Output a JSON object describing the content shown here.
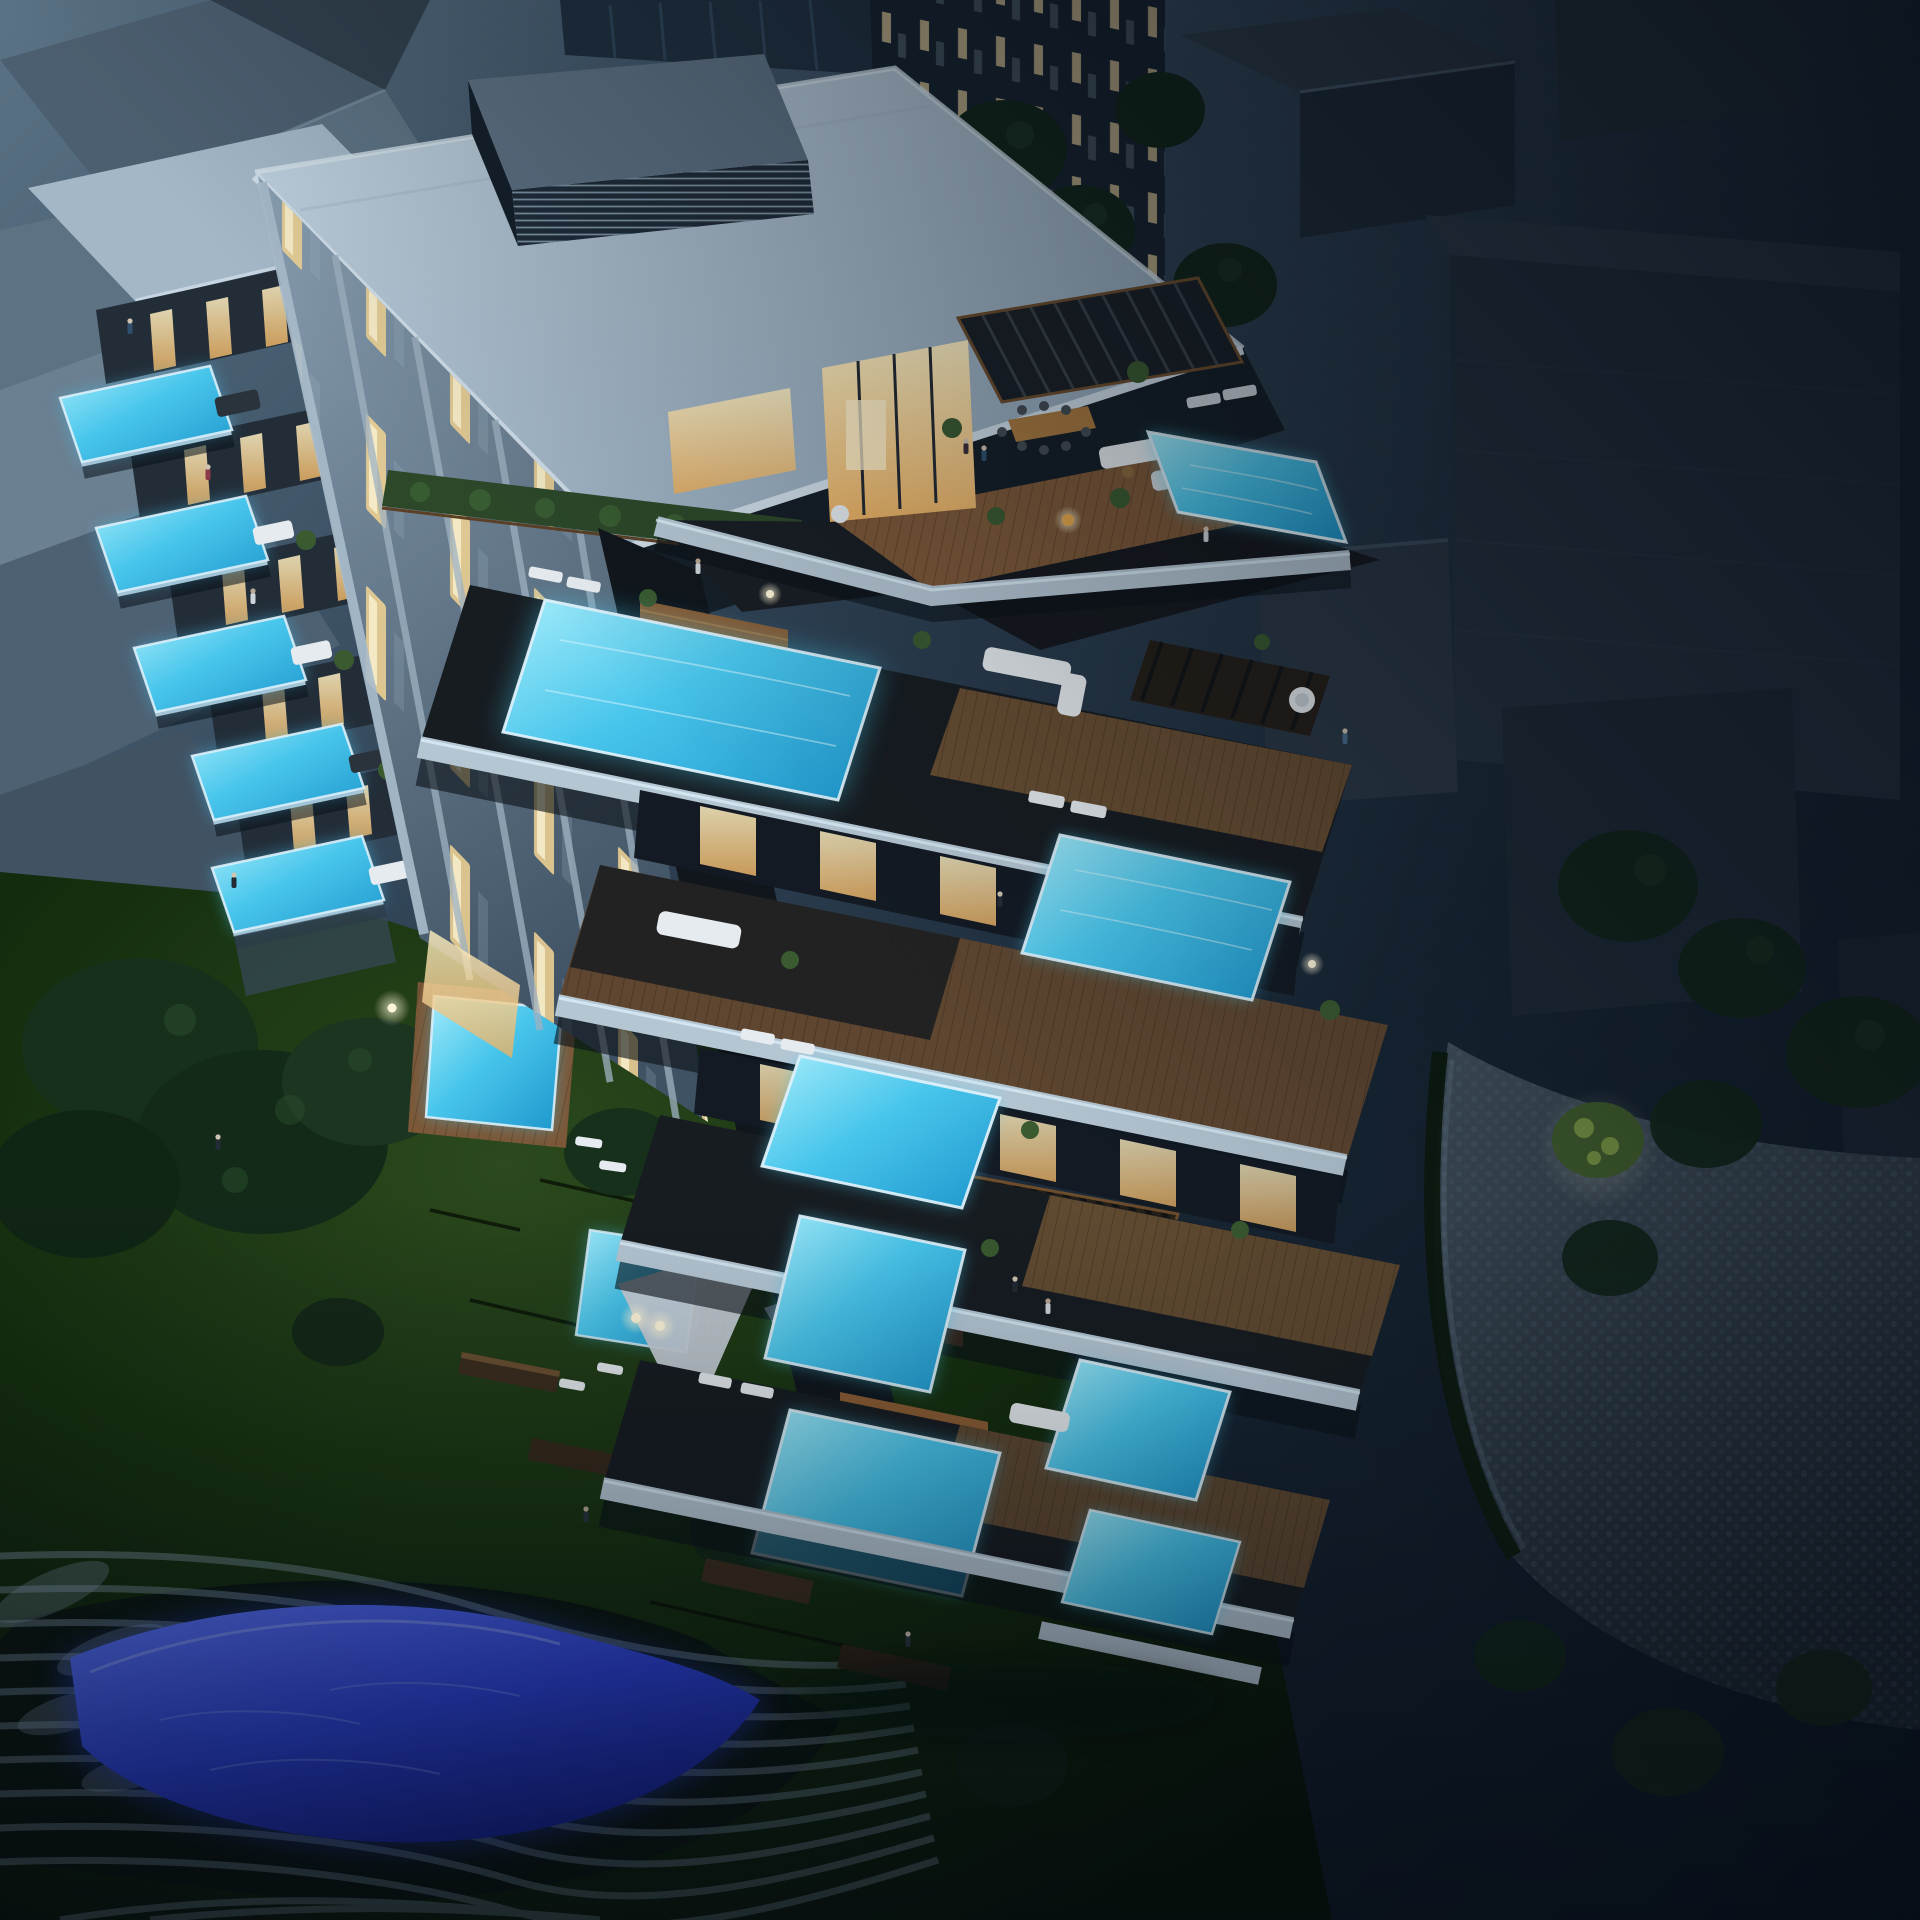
{
  "scene": {
    "description": "Aerial night-time architectural rendering of a luxury terraced apartment building with cascading balconies and glowing infinity pools, lit warm interiors, landscaped night garden with shade sails and lamps, an illuminated wavy blue water feature, a cobblestone driveway and dark surrounding city blocks and trees",
    "time_of_day": "night",
    "view": "high aerial three-quarter view"
  },
  "palette": {
    "bg-top": "#5b7386",
    "bg-deep": "#0a1420",
    "roof-light": "#b6c9d8",
    "roof-shade": "#8aa0b3",
    "cornice": "#cfdde8",
    "louver-top": "#5e7284",
    "louver-face": "#1f2c39",
    "facade-light": "#8aa0b2",
    "facade-dark": "#3f5264",
    "slab": "#b5c6d3",
    "glass-edge": "#dcf0fa",
    "deck-wood": "#7c5838",
    "deck-dark": "#171c21",
    "win-warm": "#ffe9b4",
    "win-amber": "#e8b063",
    "pool-bright": "#a5ecfa",
    "pool-mid": "#49c6ec",
    "pool-deep": "#1d96cc",
    "pool-glow": "#45cdf0",
    "pond-blue": "#2c42d8",
    "pond-deep": "#18259d",
    "ribbon": "#8ba3b8",
    "lawn-light": "#2c4a1e",
    "lawn-dark": "#081407",
    "tree-dark": "#12251a",
    "tree-lit": "#7e9a45",
    "hedge": "#2c4829",
    "cobble-light": "#43525f",
    "cobble-dark": "#1c2630",
    "sail": "#c7cfd7",
    "furniture-white": "#e6ebef",
    "furniture-dark": "#2a323c",
    "plant-green": "#3a5a30",
    "lamp-warm": "#fff6d8",
    "figure-dark": "#232b35",
    "block-light": "#5d7384",
    "block-dark": "#243240",
    "tower-dark": "#16222e"
  },
  "inventory": {
    "main_building": "terraced residential tower with lit interiors",
    "penthouse": "rooftop terrace with pergola, dining set and infinity pool",
    "cascade": "stepped terraces with infinity pools descending to garden",
    "left_wing": "stacked cantilevered balcony pools",
    "garden": "night lawn with trees, step paths, lamps and shade sails",
    "water_feature": "illuminated wavy landscape pond",
    "driveway": "cobblestone courtyard",
    "neighbors": "unlit surrounding buildings and trees"
  },
  "counts": {
    "cascade_pools": 8,
    "left_wing_pools": 5,
    "ground_pools": 2,
    "shade_sails": 2,
    "rooftop_louver_units": 1
  }
}
